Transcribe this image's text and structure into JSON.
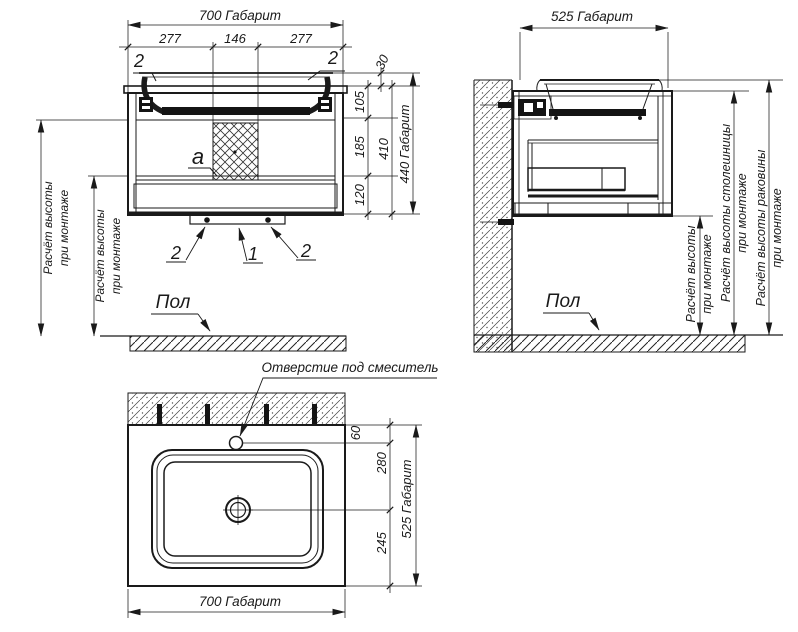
{
  "colors": {
    "line": "#1a1a1a",
    "background": "#ffffff"
  },
  "front": {
    "dim_total_width": "700 Габарит",
    "dim_w1": "277",
    "dim_w2": "146",
    "dim_w3": "277",
    "dim_30": "30",
    "dim_105": "105",
    "dim_185": "185",
    "dim_120": "120",
    "dim_410": "410",
    "dim_total_height": "440 Габарит",
    "callout_top_left": "2",
    "callout_top_right": "2",
    "callout_bottom_left": "2",
    "callout_bottom_center": "1",
    "callout_bottom_right": "2",
    "label_a": "a",
    "floor_label": "Пол",
    "note1_l1": "Расчёт высоты",
    "note1_l2": "при монтаже",
    "note2_l1": "Расчёт высоты",
    "note2_l2": "при монтаже"
  },
  "side": {
    "dim_total_depth": "525 Габарит",
    "floor_label": "Пол",
    "note_cabinet_l1": "Расчёт высоты",
    "note_cabinet_l2": "при монтаже",
    "note_countertop_l1": "Расчёт высоты столешницы",
    "note_countertop_l2": "при монтаже",
    "note_sink_l1": "Расчёт высоты раковины",
    "note_sink_l2": "при монтаже"
  },
  "plan": {
    "faucet_note": "Отверстие под смеситель",
    "dim_60": "60",
    "dim_280": "280",
    "dim_245": "245",
    "dim_total_depth": "525 Габарит",
    "dim_total_width": "700 Габарит"
  }
}
